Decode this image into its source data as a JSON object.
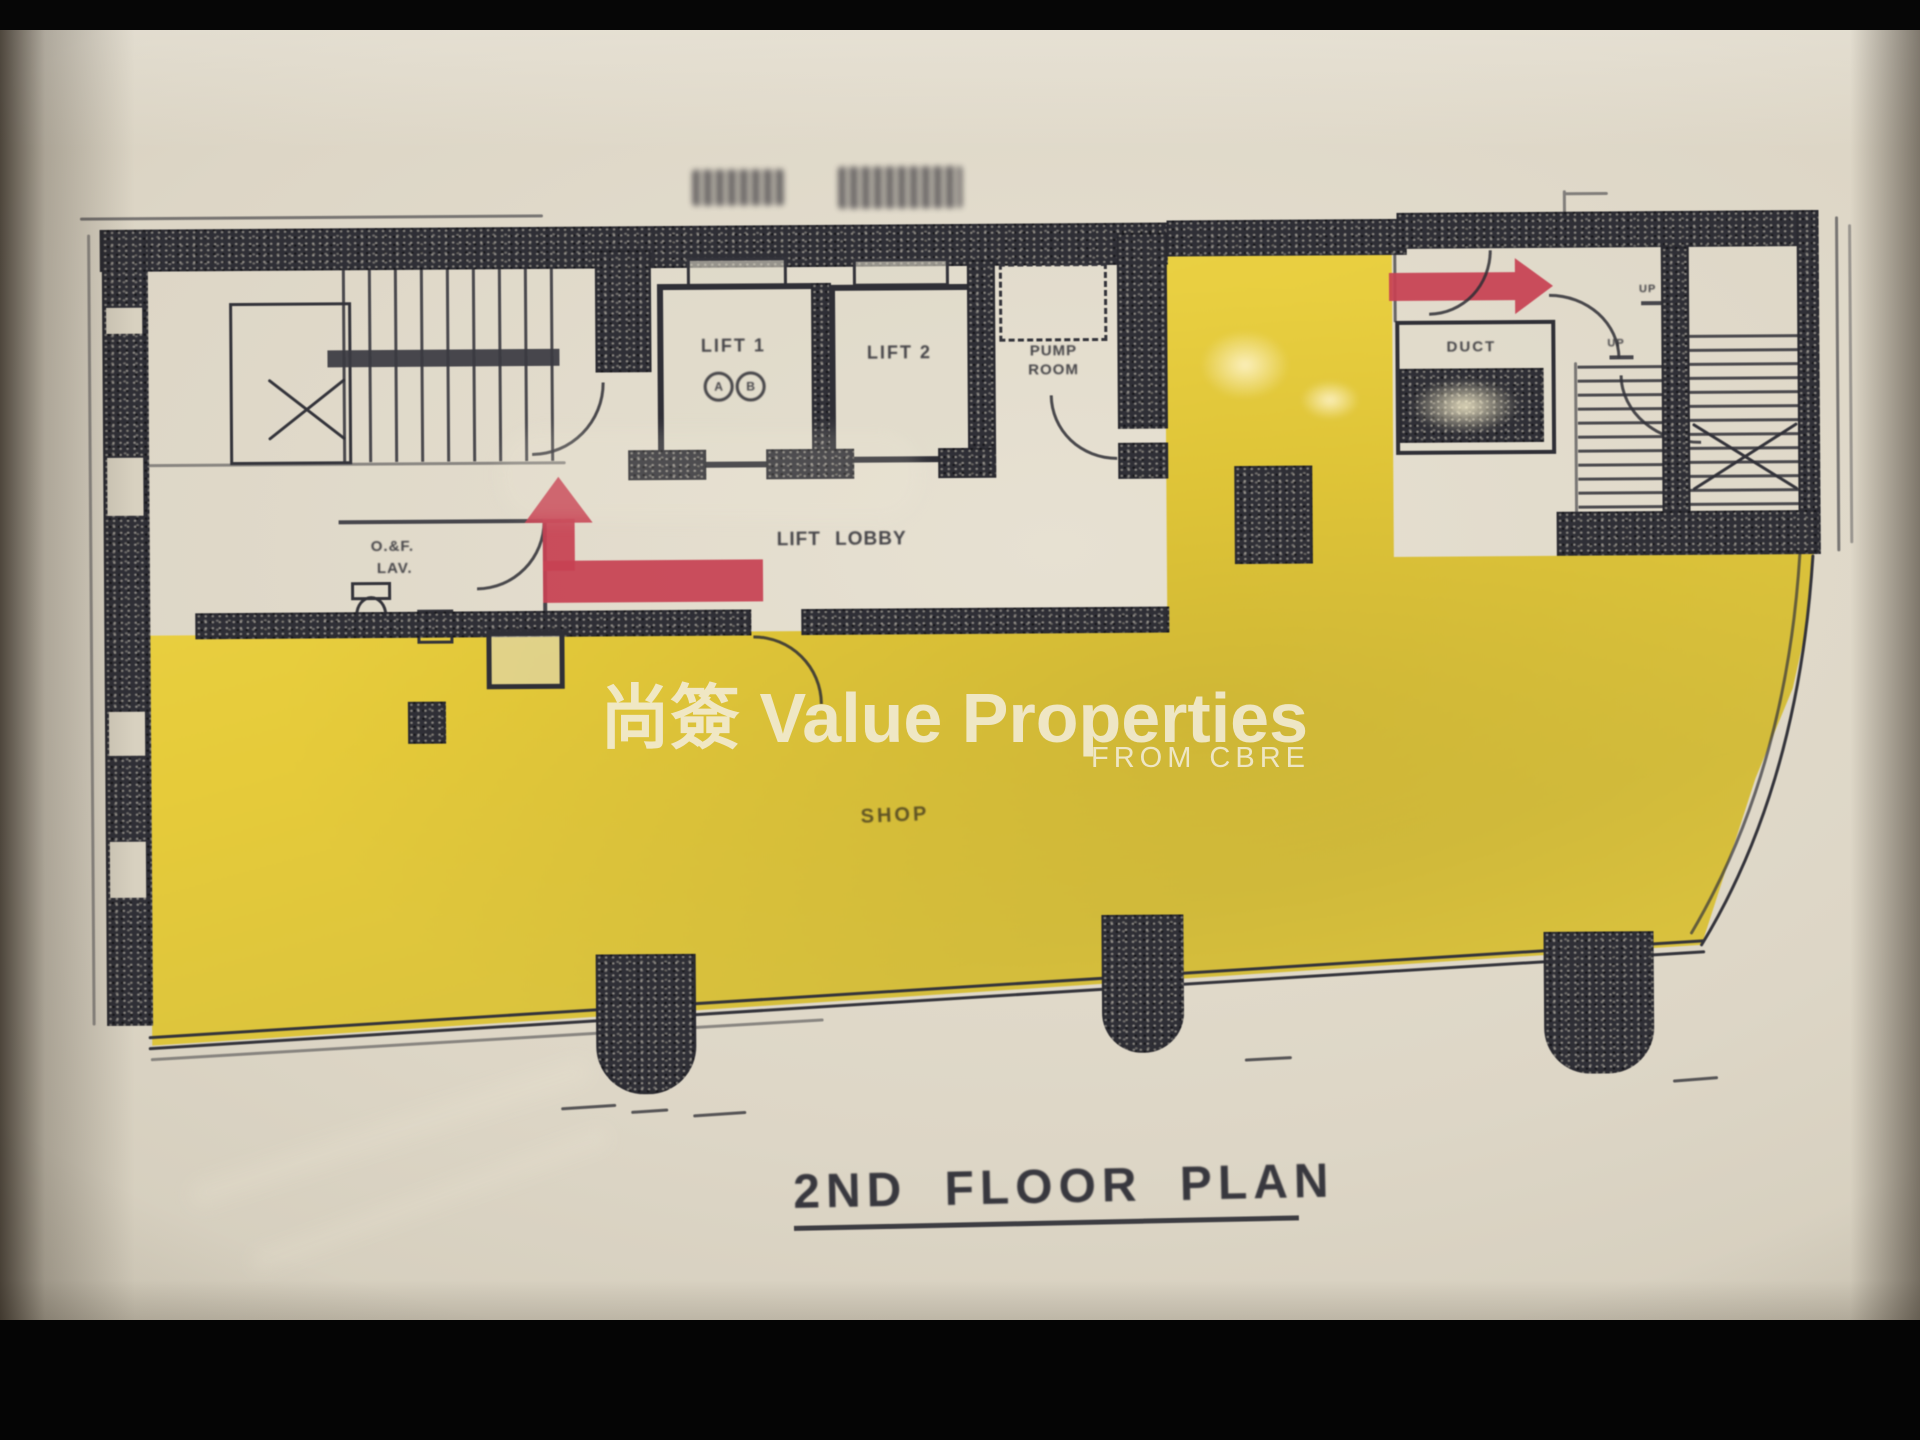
{
  "plan": {
    "title": "2ND FLOOR PLAN",
    "labels": {
      "lift1": "LIFT 1",
      "lift1_badge_a": "A",
      "lift1_badge_b": "B",
      "lift2": "LIFT 2",
      "pump_line1": "PUMP",
      "pump_line2": "ROOM",
      "lift_lobby": "LIFT LOBBY",
      "lav_line1": "O.&F.",
      "lav_line2": "LAV.",
      "duct": "DUCT",
      "up": "UP",
      "shop": "SHOP"
    }
  },
  "watermark": {
    "brand_cjk": "尚簽",
    "brand_en": " Value Properties",
    "sub": "FROM CBRE"
  },
  "colors": {
    "highlight_yellow": "#e7cd3f",
    "arrow_red": "#c74253",
    "ink": "#2f2f36",
    "paper": "#dcd5c5",
    "watermark_text": "#f3edd8"
  }
}
